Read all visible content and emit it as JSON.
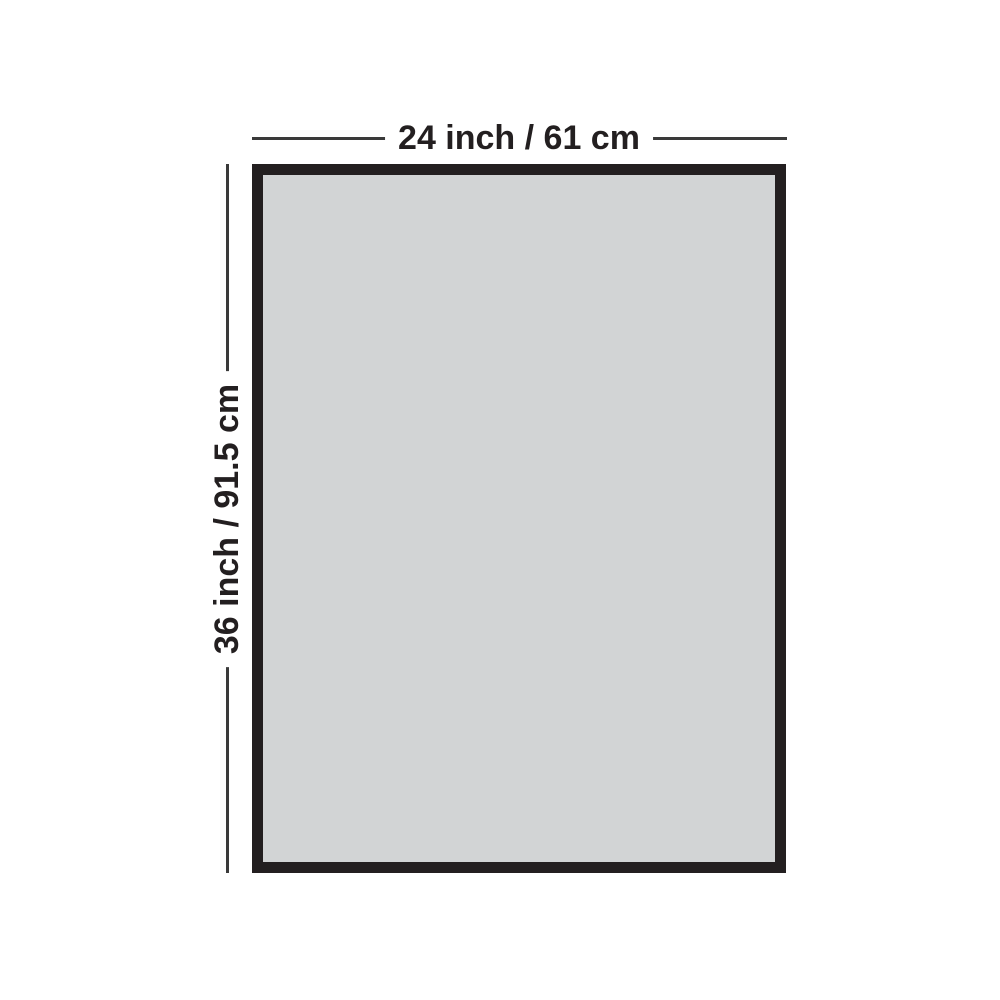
{
  "diagram": {
    "type": "dimension-diagram",
    "width_label": "24 inch / 61 cm",
    "height_label": "36 inch / 91.5 cm",
    "colors": {
      "background": "#ffffff",
      "frame_border": "#231f20",
      "frame_fill": "#d2d4d5",
      "dimension_line": "#3a3a3a",
      "label_text": "#231f20"
    }
  }
}
